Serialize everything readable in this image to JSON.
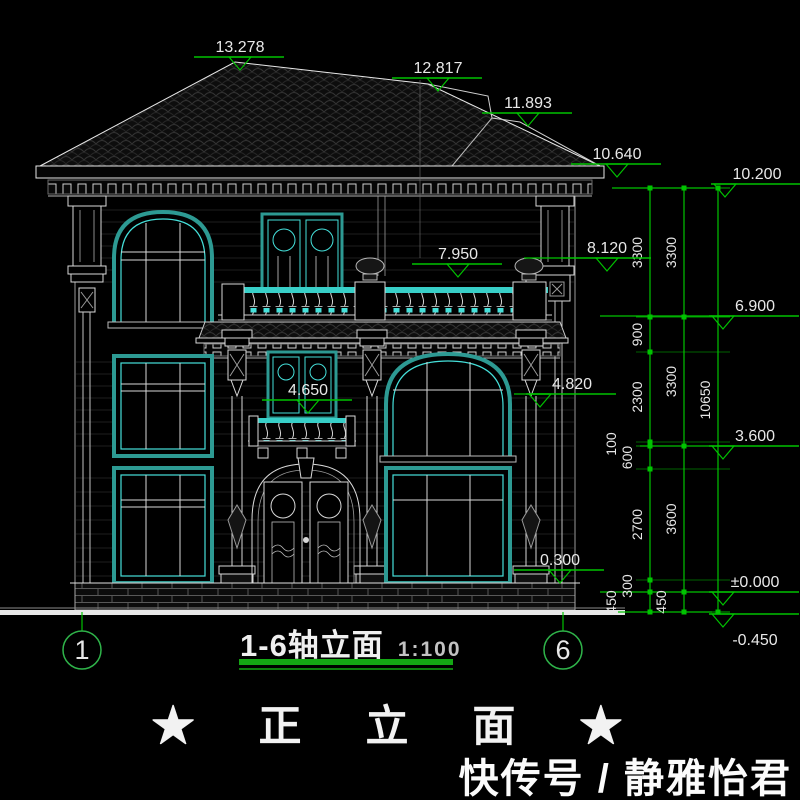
{
  "title_block": {
    "axis_range_label": "1-6轴立面",
    "scale_label": "1:100"
  },
  "caption": "★ 正 立 面 ★",
  "watermark": "快传号 / 静雅怡君",
  "colors": {
    "dim_green": "#00c300",
    "axis_green": "#2fb44a",
    "frame_teal": "#2d9a93",
    "bright_cyan": "#45e0da",
    "text_white": "#e8e8e8"
  },
  "axis_bubbles": [
    {
      "label": "1",
      "x": 82,
      "y": 650
    },
    {
      "label": "6",
      "x": 563,
      "y": 650
    }
  ],
  "elevation_markers": [
    {
      "value": "13.278",
      "x": 240,
      "y": 57,
      "tri": "center"
    },
    {
      "value": "12.817",
      "x": 438,
      "y": 78,
      "tri": "center"
    },
    {
      "value": "11.893",
      "x": 528,
      "y": 113,
      "tri": "center"
    },
    {
      "value": "10.640",
      "x": 617,
      "y": 164,
      "tri": "center"
    },
    {
      "value": "10.200",
      "x": 757,
      "y": 184,
      "tri": "left"
    },
    {
      "value": "8.120",
      "x": 607,
      "y": 258,
      "tri": "center"
    },
    {
      "value": "7.950",
      "x": 458,
      "y": 264,
      "tri": "center"
    },
    {
      "value": "6.900",
      "x": 755,
      "y": 316,
      "tri": "left"
    },
    {
      "value": "4.820",
      "x": 572,
      "y": 394,
      "tri": "left"
    },
    {
      "value": "4.650",
      "x": 308,
      "y": 400,
      "tri": "center"
    },
    {
      "value": "3.600",
      "x": 755,
      "y": 446,
      "tri": "left"
    },
    {
      "value": "0.300",
      "x": 560,
      "y": 570,
      "tri": "center"
    },
    {
      "value": "±0.000",
      "x": 755,
      "y": 592,
      "tri": "left"
    },
    {
      "value": "-0.450",
      "x": 755,
      "y": 614,
      "tri": "left",
      "below": true
    }
  ],
  "dimension_chains": [
    {
      "x": 650,
      "boundaries": [
        188,
        317,
        352,
        442,
        446,
        469,
        580,
        592,
        612
      ],
      "labels": [
        "3300",
        "900",
        "2300",
        "100",
        "600",
        "2700",
        "300",
        "450"
      ],
      "dx": [
        -8,
        -8,
        -8,
        -34,
        -18,
        -8,
        -18,
        -34
      ]
    },
    {
      "x": 684,
      "boundaries": [
        188,
        317,
        446,
        592,
        612
      ],
      "labels": [
        "3300",
        "3300",
        "3600",
        "450"
      ],
      "dx": [
        -8,
        -8,
        -8,
        -18
      ]
    },
    {
      "x": 718,
      "boundaries": [
        188,
        612
      ],
      "labels": [
        "10650"
      ],
      "dx": [
        -8
      ]
    }
  ],
  "green_lines": [
    [
      612,
      188,
      714,
      188
    ],
    [
      600,
      316,
      712,
      316
    ],
    [
      640,
      446,
      712,
      446
    ],
    [
      600,
      592,
      712,
      592
    ],
    [
      618,
      612,
      712,
      612
    ],
    [
      524,
      258,
      561,
      258
    ],
    [
      514,
      394,
      549,
      394
    ],
    [
      82,
      612,
      82,
      631
    ],
    [
      563,
      612,
      563,
      631
    ]
  ]
}
